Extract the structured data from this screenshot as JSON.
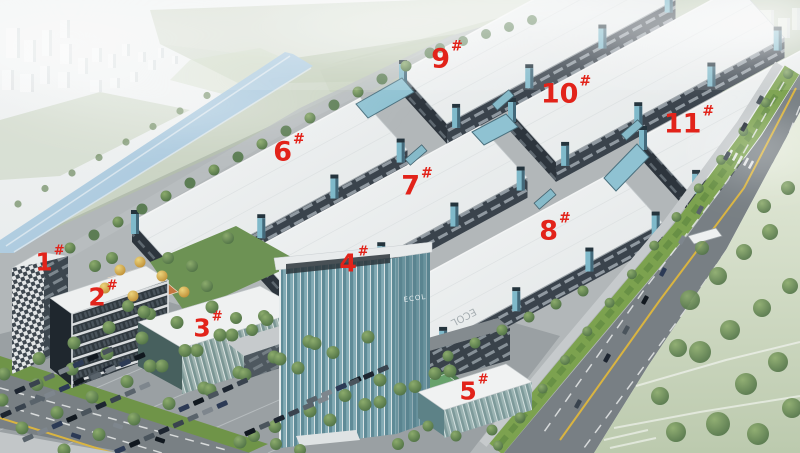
{
  "scene": {
    "type": "aerial architectural rendering",
    "subject": "industrial park campus with eleven numbered buildings",
    "label_color": "#e2231a"
  },
  "buildings": [
    {
      "num": "1",
      "mark": "#"
    },
    {
      "num": "2",
      "mark": "#"
    },
    {
      "num": "3",
      "mark": "#"
    },
    {
      "num": "4",
      "mark": "#"
    },
    {
      "num": "5",
      "mark": "#"
    },
    {
      "num": "6",
      "mark": "#"
    },
    {
      "num": "7",
      "mark": "#"
    },
    {
      "num": "8",
      "mark": "#"
    },
    {
      "num": "9",
      "mark": "#"
    },
    {
      "num": "10",
      "mark": "#"
    },
    {
      "num": "11",
      "mark": "#"
    }
  ],
  "signs": {
    "tower_logo": "ECOL",
    "roof_sign": "ECOL"
  }
}
